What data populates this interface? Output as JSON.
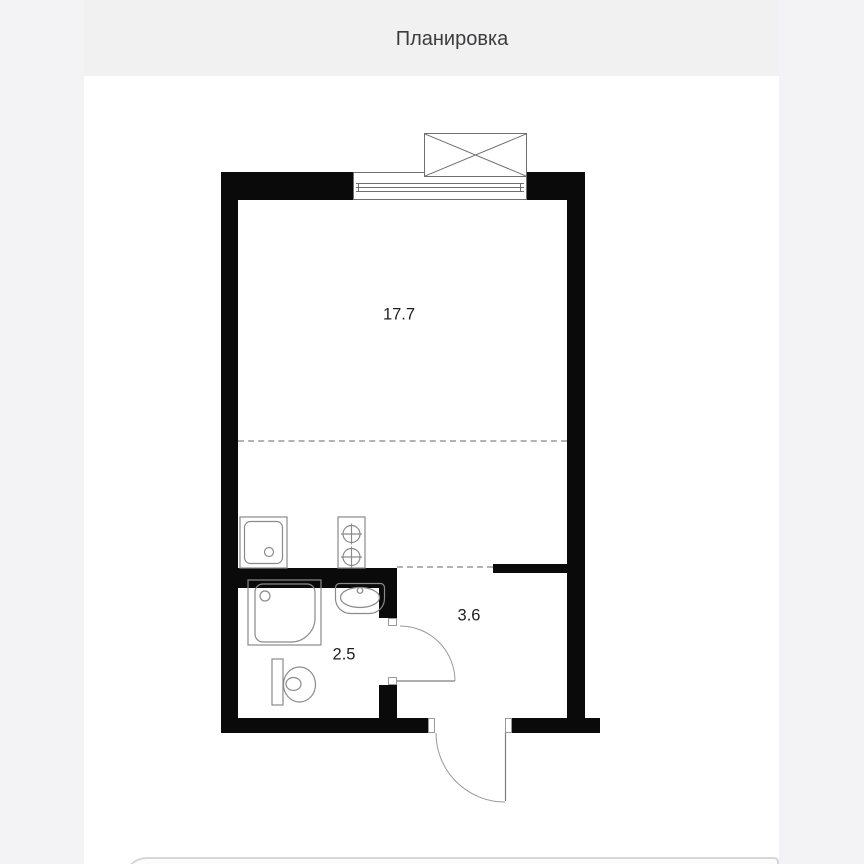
{
  "header": {
    "title": "Планировка"
  },
  "floor_plan": {
    "rooms": [
      {
        "id": "living-room",
        "area": "17.7"
      },
      {
        "id": "hallway",
        "area": "3.6"
      },
      {
        "id": "bathroom",
        "area": "2.5"
      }
    ],
    "colors": {
      "wall": "#0a0a0a",
      "thin_line": "#8a8a8a",
      "window_line": "#6f6f6f",
      "dashed_line": "#b3b3b3",
      "label_text": "#1f1f1f",
      "header_band": "#f1f1f2",
      "page_side": "#f3f3f5",
      "plan_background": "#ffffff"
    }
  }
}
